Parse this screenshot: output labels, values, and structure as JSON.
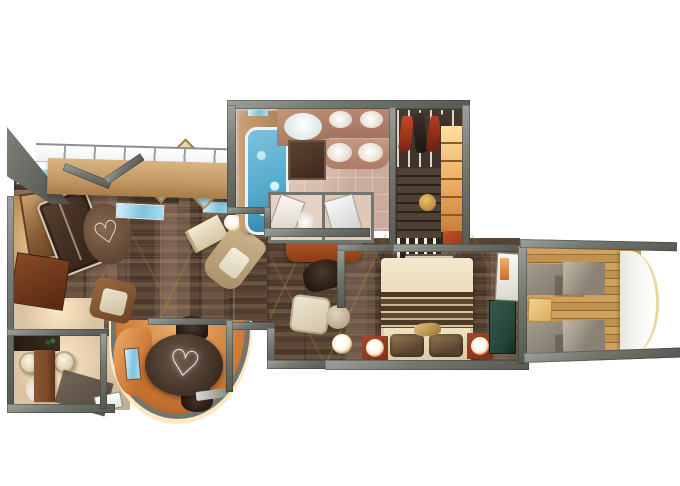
{
  "title": "cruise-suite-floor-plan",
  "palette": {
    "wall": "#73766e",
    "wallDark": "#565951",
    "wallLight": "#9da19a",
    "floorWood": "#523e30",
    "vine": "#a8873f",
    "bathTile": "#cbab9e",
    "bathWall": "#b08272",
    "closetFloor": "#3e322a",
    "deck": "#c08e4f",
    "railing": "#f4f5f1",
    "railEdge": "#e9d89b",
    "copper": "#c4702f",
    "copperLight": "#efae6a",
    "espresso": "#3a281d",
    "cream": "#e9dcc2",
    "red": "#a84426",
    "redDark": "#7e2d14",
    "teal": "#24443a",
    "water": "#55abce",
    "woodWall": "#c59a67",
    "tan": "#d9b98c",
    "beige": "#d9c3a3",
    "glow": "#ffe9c4",
    "doorBrown": "#7b4a2a",
    "green": "#1d3d22",
    "padGray": "#8f897c",
    "padLight": "#b7afa0"
  },
  "motifs": {
    "rug_heart": "♡",
    "table_swirl": "♡"
  },
  "scene": {
    "rooms": [
      {
        "name": "living-room",
        "items": [
          "sofa",
          "oval-rug",
          "armchair",
          "chaise-lounge",
          "artwork",
          "planter",
          "glass-panels",
          "diamond-wall-art",
          "floor-lamp",
          "book"
        ]
      },
      {
        "name": "dining-nook",
        "items": [
          "oval-dining-table",
          "dining-chair",
          "dining-chair",
          "copper-console",
          "curved-bay-wall",
          "tray"
        ]
      },
      {
        "name": "entry",
        "items": [
          "console-desk",
          "minibar",
          "entry-door"
        ]
      },
      {
        "name": "guest-bathroom",
        "items": [
          "sink",
          "sink",
          "toilet",
          "door"
        ]
      },
      {
        "name": "master-bathroom",
        "items": [
          "jacuzzi-tub",
          "ceiling-light-oval",
          "double-vanity",
          "double-vanity",
          "mirror",
          "toilet-room",
          "shower-room"
        ]
      },
      {
        "name": "walk-in-closet",
        "items": [
          "hanging-garments",
          "shoe-shelves",
          "lit-wardrobe",
          "stool",
          "luggage-rack",
          "bench"
        ]
      },
      {
        "name": "master-bedroom",
        "items": [
          "king-bed",
          "striped-throw",
          "headboard",
          "nightstand-lamp",
          "nightstand-lamp",
          "tv-bench",
          "teal-chest",
          "balcony-door",
          "desk",
          "desk-chair",
          "hall-armchair",
          "side-table",
          "sphere-lamp"
        ]
      },
      {
        "name": "balcony",
        "items": [
          "lounger",
          "lounger",
          "side-table",
          "curved-railing",
          "teak-deck"
        ]
      }
    ]
  }
}
